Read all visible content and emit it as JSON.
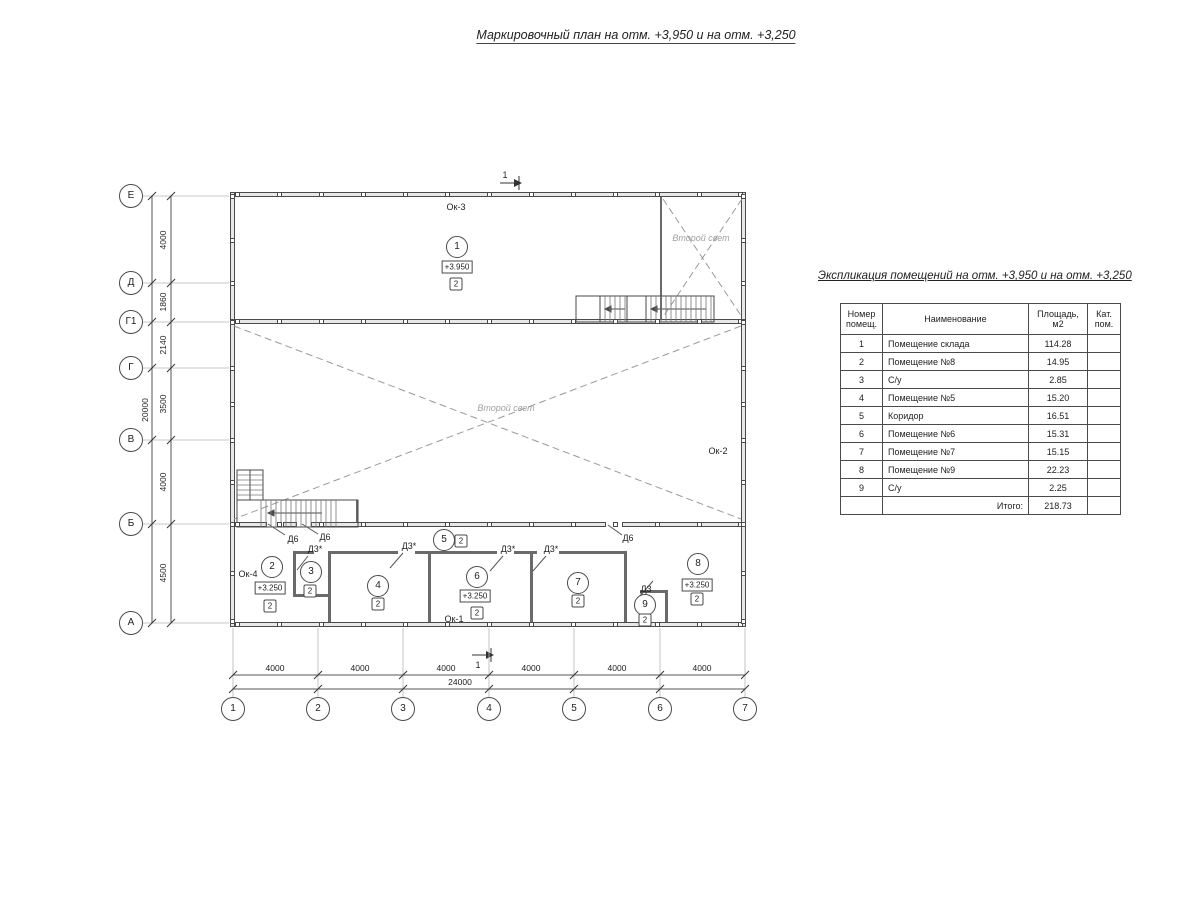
{
  "page": {
    "title": "Маркировочный план на отм. +3,950 и на отм. +3,250"
  },
  "plan": {
    "axes": {
      "left": [
        {
          "label": "Е",
          "y": 196
        },
        {
          "label": "Д",
          "y": 283
        },
        {
          "label": "Г1",
          "y": 322
        },
        {
          "label": "Г",
          "y": 368
        },
        {
          "label": "В",
          "y": 440
        },
        {
          "label": "Б",
          "y": 524
        },
        {
          "label": "А",
          "y": 623
        }
      ],
      "bottom": [
        {
          "label": "1",
          "x": 233
        },
        {
          "label": "2",
          "x": 318
        },
        {
          "label": "3",
          "x": 403
        },
        {
          "label": "4",
          "x": 489
        },
        {
          "label": "5",
          "x": 574
        },
        {
          "label": "6",
          "x": 660
        },
        {
          "label": "7",
          "x": 745
        }
      ]
    },
    "dimensions": {
      "left": [
        {
          "text": "4000",
          "y": 240
        },
        {
          "text": "1860",
          "y": 302
        },
        {
          "text": "2140",
          "y": 345
        },
        {
          "text": "3500",
          "y": 404
        },
        {
          "text": "4000",
          "y": 482
        },
        {
          "text": "4500",
          "y": 573
        }
      ],
      "left_total": {
        "text": "20000",
        "y": 410
      },
      "bottom": [
        {
          "text": "4000",
          "x": 275
        },
        {
          "text": "4000",
          "x": 360
        },
        {
          "text": "4000",
          "x": 446
        },
        {
          "text": "4000",
          "x": 531
        },
        {
          "text": "4000",
          "x": 617
        },
        {
          "text": "4000",
          "x": 702
        }
      ],
      "bottom_total": {
        "text": "24000",
        "x": 460
      }
    },
    "rooms": [
      {
        "num": "1",
        "x": 457,
        "y": 247,
        "elev": "+3.950",
        "ex": 457,
        "ey": 267,
        "cat": "2",
        "cx": 456,
        "cy": 284
      },
      {
        "num": "2",
        "x": 272,
        "y": 567,
        "elev": "+3.250",
        "ex": 270,
        "ey": 588,
        "cat": "2",
        "cx": 270,
        "cy": 606
      },
      {
        "num": "3",
        "x": 311,
        "y": 572,
        "cat": "2",
        "cx": 310,
        "cy": 591
      },
      {
        "num": "4",
        "x": 378,
        "y": 586,
        "cat": "2",
        "cx": 378,
        "cy": 604
      },
      {
        "num": "5",
        "x": 444,
        "y": 540,
        "cat": "2",
        "cx": 461,
        "cy": 541
      },
      {
        "num": "6",
        "x": 477,
        "y": 577,
        "elev": "+3.250",
        "ex": 475,
        "ey": 596,
        "cat": "2",
        "cx": 477,
        "cy": 613
      },
      {
        "num": "7",
        "x": 578,
        "y": 583,
        "cat": "2",
        "cx": 578,
        "cy": 601
      },
      {
        "num": "8",
        "x": 698,
        "y": 564,
        "elev": "+3.250",
        "ex": 697,
        "ey": 585,
        "cat": "2",
        "cx": 697,
        "cy": 599
      },
      {
        "num": "9",
        "x": 645,
        "y": 605,
        "cat": "2",
        "cx": 645,
        "cy": 620
      }
    ],
    "windows": [
      {
        "label": "Ок-3",
        "x": 456,
        "y": 207
      },
      {
        "label": "Ок-2",
        "x": 718,
        "y": 451
      },
      {
        "label": "Ок-4",
        "x": 248,
        "y": 574
      },
      {
        "label": "Ок-1",
        "x": 454,
        "y": 619
      }
    ],
    "doors": [
      {
        "label": "Д6",
        "x": 293,
        "y": 539
      },
      {
        "label": "Д6",
        "x": 325,
        "y": 537
      },
      {
        "label": "Д3*",
        "x": 315,
        "y": 549
      },
      {
        "label": "Д3*",
        "x": 409,
        "y": 546
      },
      {
        "label": "Д3*",
        "x": 508,
        "y": 549
      },
      {
        "label": "Д3*",
        "x": 551,
        "y": 549
      },
      {
        "label": "Д6",
        "x": 628,
        "y": 538
      },
      {
        "label": "Д3",
        "x": 646,
        "y": 589
      }
    ],
    "void_labels": [
      {
        "text": "Второй свет",
        "x": 701,
        "y": 238
      },
      {
        "text": "Второй свет",
        "x": 506,
        "y": 408
      }
    ],
    "section_marks": [
      {
        "label": "1",
        "x": 505,
        "y": 175
      },
      {
        "label": "1",
        "x": 478,
        "y": 665
      }
    ]
  },
  "table": {
    "title": "Экспликация помещений на отм. +3,950 и на отм. +3,250",
    "columns": [
      "Номер\nпомещ.",
      "Наименование",
      "Площадь,\nм2",
      "Кат.\nпом."
    ],
    "rows": [
      [
        "1",
        "Помещение склада",
        "114.28",
        ""
      ],
      [
        "2",
        "Помещение №8",
        "14.95",
        ""
      ],
      [
        "3",
        "С/у",
        "2.85",
        ""
      ],
      [
        "4",
        "Помещение №5",
        "15.20",
        ""
      ],
      [
        "5",
        "Коридор",
        "16.51",
        ""
      ],
      [
        "6",
        "Помещение №6",
        "15.31",
        ""
      ],
      [
        "7",
        "Помещение №7",
        "15.15",
        ""
      ],
      [
        "8",
        "Помещение №9",
        "22.23",
        ""
      ],
      [
        "9",
        "С/у",
        "2.25",
        ""
      ]
    ],
    "total_label": "Итого:",
    "total_value": "218.73"
  }
}
